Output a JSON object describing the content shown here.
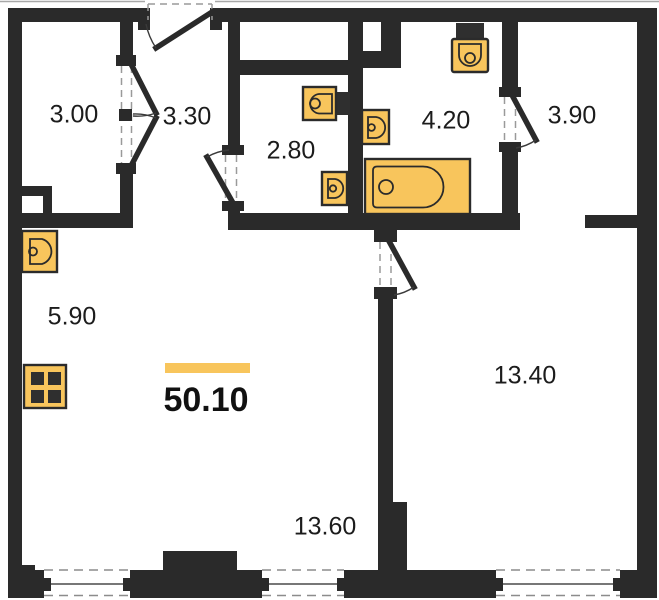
{
  "title": "Apartment floor plan",
  "total": {
    "area": "50.10"
  },
  "rooms": [
    {
      "name": "storage",
      "area": "3.00"
    },
    {
      "name": "entry-hall",
      "area": "3.30"
    },
    {
      "name": "wc",
      "area": "2.80"
    },
    {
      "name": "bathroom",
      "area": "4.20"
    },
    {
      "name": "hall",
      "area": "3.90"
    },
    {
      "name": "kitchen",
      "area": "5.90"
    },
    {
      "name": "bedroom",
      "area": "13.40"
    },
    {
      "name": "living-room",
      "area": "13.60"
    }
  ],
  "fixtures": [
    "kitchen-sink",
    "stove",
    "wc-sink",
    "wc-hand-basin",
    "bathroom-sink",
    "toilet",
    "bathtub"
  ],
  "colors": {
    "wall": "#2a2a2a",
    "fixture_fill": "#f8c55c",
    "fixture_stroke": "#2b2b2b",
    "accent_bar": "#f8c55c",
    "dash": "#9a9a9a",
    "sill": "#4a4a4a",
    "text": "#1c1c1c"
  }
}
